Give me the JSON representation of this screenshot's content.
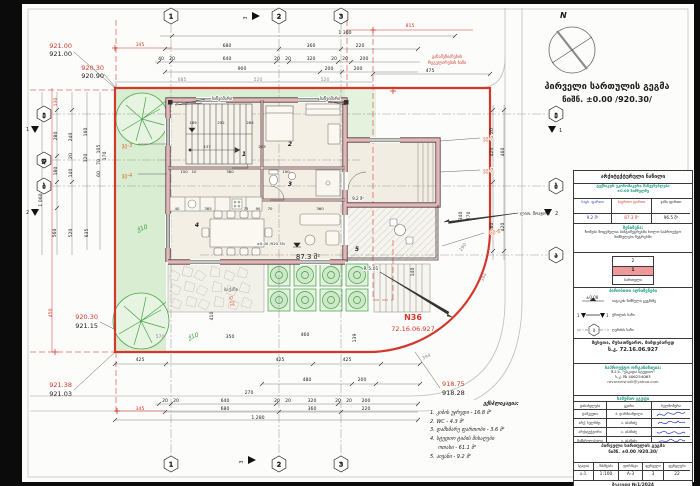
{
  "title": {
    "l1": "პირველი სართულის გეგმა",
    "l2": "ნიშნ. ±0.00 /920.30/"
  },
  "compass": {
    "n": "N"
  },
  "axes": {
    "a1": "1",
    "a2": "2",
    "a3": "3",
    "ae": "ე",
    "ad": "დ",
    "ab": "ბ",
    "aa": "ა",
    "s1": "1",
    "s2": "2",
    "s3": "3"
  },
  "elev": {
    "tl_r": "921.00",
    "tl_b": "921.00",
    "tl2_r": "920.30",
    "tl2_b": "920.90",
    "ml_r": "920.30",
    "ml_b": "921.15",
    "bl_r": "921.38",
    "bl_b": "921.03",
    "br_r": "918.75",
    "br_b": "918.28"
  },
  "d": {
    "n1300": "1 300",
    "n680": "680",
    "n360": "360",
    "n220": "220",
    "n40": "40",
    "n20": "20",
    "n640": "640",
    "n320": "320",
    "n200": "200",
    "n900": "900",
    "n685": "685",
    "n520": "520",
    "n475": "475",
    "n815": "815",
    "n345": "345",
    "n130": "130",
    "n450": "450",
    "n1280": "1 280",
    "n270": "270",
    "n425": "425",
    "n480": "480",
    "n570": "570",
    "n410": "410",
    "n350": "350",
    "n139": "139",
    "n394": "394",
    "n290": "290",
    "n420": "420",
    "n460": "460",
    "n380": "380",
    "n340": "340",
    "n280": "280",
    "n180": "180",
    "n240": "240",
    "n140": "140",
    "n160": "160",
    "n120": "120",
    "n105": "105",
    "n70": "70",
    "n60": "60",
    "n170": "170",
    "n1060": "1 060",
    "n560": "560",
    "n635": "635",
    "n137": "137",
    "n203": "203",
    "n285": "285",
    "n385": "385",
    "n90": "90",
    "n75": "75",
    "n150": "150",
    "n190": "190",
    "n10": "10",
    "n189": "189",
    "n252": "252"
  },
  "labels": {
    "downspout": "საწვიმარი",
    "railing": "ლით. მოაჯირი",
    "regline1": "განაშენიანების",
    "regline2": "რეგულირების ხაზი",
    "vg3": "ვგ-3",
    "vg4": "ვგ-4",
    "vg5": "ვგ-5",
    "vg6": "ვგ-6",
    "vg7": "ვგ-7",
    "platform": "ბაქანი",
    "plant": "ჭ10",
    "n36": "N36",
    "cad": "72.16.06.927",
    "r": "R 5.01",
    "area_main": "87.3 მ²",
    "area_balc": "9.2 მ²",
    "mark": "±0.00 /920.35/",
    "r1": "1",
    "r2": "2",
    "r3": "3",
    "r4": "4",
    "r5": "5"
  },
  "tb": {
    "part": "არქიტექტურული ნაწილი",
    "tech1": "ტექნიკურ ეკონომიკური მაჩვენებლები",
    "tech2": "±0.00 ნიშნულზე",
    "col1": "საცხ. ფართი",
    "col2": "საერთო ფართი",
    "col3": "ჯამი ფართი",
    "v1": "9.2 მ²",
    "v2": "87.3 მ²",
    "v3": "96.5 მ²",
    "noteh": "შენიშვნა:",
    "note": "ზომები მოცემულია სანტიმეტრებში ხოლო საპროექტო ნიშნულები მეტრებში",
    "fl2": "2",
    "fl1": "1",
    "fll": "სართული",
    "legendh": "პირობითი აღნიშვნები",
    "leg1": "იატაკის ნიშნული გეგმაზე",
    "leg1s": "±0.00",
    "leg2": "ჭრილის ხაზი",
    "leg2a": "1",
    "leg2b": "1",
    "leg3": "ღერძის ხაზი",
    "leg3s": "ბ",
    "addr1": "მცხეთა, მუხათწყარო, მიმდებარედ",
    "addr2": "ს.კ. 72.16.06.927",
    "orgh": "საპროექტო ორგანიზაცია:",
    "org1": "შ.პ.ს. \"ესკადა სტუდიო\"",
    "org2": "ს.კ. № 406254063",
    "org3": "revorevishvili@yahoo.com",
    "teamh": "სამუშაო ჯგუფი",
    "th1": "დასახელება",
    "th2": "გვარი",
    "th3": "ხელმოწერა",
    "rows": [
      [
        "დამკვეთი",
        "ბ. დარჩიაშვილი"
      ],
      [
        "არქ. ხელმძღ.",
        "ა. აბაშიძე"
      ],
      [
        "არქიტექტორი",
        "ა. აბაშიძე"
      ],
      [
        "შემსრულებელი",
        "ა. აბაშიძე"
      ]
    ],
    "pt1": "პირველი სართულის გეგმა",
    "pt2": "ნიშნ. ±0.00 /920.30/",
    "m1": "სტადია",
    "m2": "მასშტაბი",
    "m3": "ფორმატი",
    "m4": "ფურცელი",
    "m5": "ფურცლები",
    "mv1": "ა.პ.",
    "mv2": "1:100",
    "mv3": "A-3",
    "mv4": "3",
    "mv5": "22",
    "order": "შეკვეთა №1/2024"
  },
  "ex": {
    "title": "ექსპლიკაცია:",
    "i1": "1. კიბის უჯრედი - 16.8 მ²",
    "i2": "2. WC - 4.3 მ²",
    "i3": "3. დამხმარე ფართობი - 3.6 მ²",
    "i4": "4. სტუდიო ტიპის მისაღები",
    "i4b": "ოთახი - 61.1 მ²",
    "i5": "5. აივანი - 9.2 მ²"
  }
}
